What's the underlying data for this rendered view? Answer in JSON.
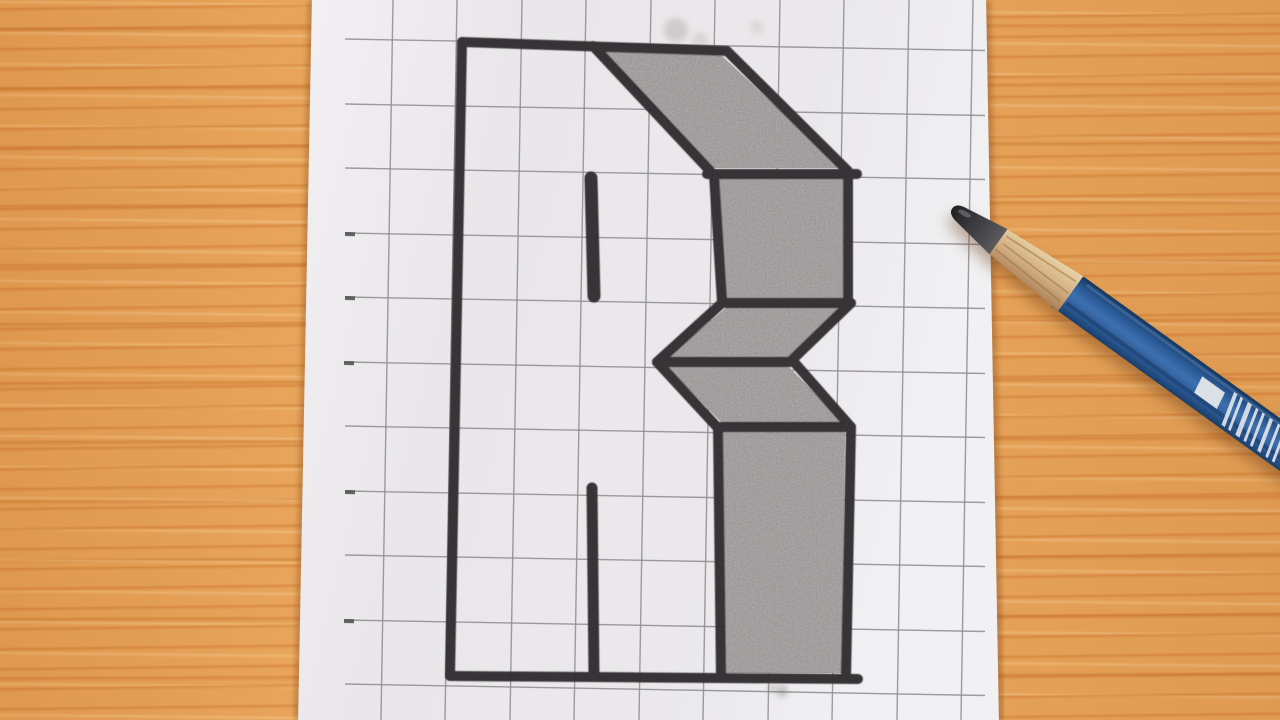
{
  "scene": {
    "type": "photograph",
    "subject": "hand-drawn 3D block letter B on graph paper, blue pencil resting on wooden desk",
    "desk": {
      "base_color": "#eaa85e",
      "streak_dark": "#cd7830",
      "streak_light": "#f8cb8c",
      "streak_deep": "#c16822"
    },
    "paper": {
      "polygon": [
        [
          312,
          -5
        ],
        [
          986,
          -5
        ],
        [
          999,
          725
        ],
        [
          298,
          725
        ]
      ],
      "gradient": [
        [
          0,
          "#f2f0f2"
        ],
        [
          0.3,
          "#e9e7e9"
        ],
        [
          0.72,
          "#eae8ea"
        ],
        [
          1,
          "#f1f0f2"
        ]
      ],
      "edge_shadow": "rgba(125,68,25,0.40)"
    },
    "grid": {
      "color": "#8d8b8e",
      "width": 1.4,
      "opacity": 0.85,
      "left_x": 345,
      "right_x": 985,
      "h_slope": 11.5,
      "v_slope": -12,
      "h_lines_y": [
        39,
        104,
        168,
        233,
        297,
        362,
        426,
        491,
        555,
        620,
        684
      ],
      "v_lines_x": [
        393,
        457,
        522,
        586,
        651,
        715,
        780,
        844,
        909,
        973
      ],
      "tick_color": "#4e4c4e",
      "ticks": [
        [
          345,
          234
        ],
        [
          345,
          298
        ],
        [
          344,
          363
        ],
        [
          345,
          492
        ],
        [
          344,
          621
        ]
      ]
    },
    "drawing": {
      "marker_color": "#312f31",
      "stroke_width": 10,
      "outline_segments": [
        [
          462,
          42,
          727,
          51
        ],
        [
          462,
          42,
          450,
          676
        ],
        [
          450,
          676,
          858,
          679
        ],
        [
          593,
          46,
          711,
          172
        ],
        [
          727,
          51,
          848,
          171
        ],
        [
          707,
          174,
          857,
          174
        ],
        [
          714,
          175,
          722,
          302
        ],
        [
          848,
          172,
          848,
          302
        ],
        [
          722,
          303,
          851,
          303
        ],
        [
          722,
          303,
          657,
          362
        ],
        [
          851,
          303,
          791,
          361
        ],
        [
          657,
          362,
          794,
          362
        ],
        [
          657,
          362,
          718,
          428
        ],
        [
          794,
          362,
          851,
          427
        ],
        [
          718,
          427,
          851,
          427
        ],
        [
          718,
          427,
          721,
          678
        ],
        [
          851,
          427,
          846,
          678
        ]
      ],
      "thick_dashes": [
        [
          591,
          178,
          594,
          296,
          13
        ],
        [
          592,
          488,
          594,
          676,
          11
        ]
      ],
      "shade_fill": "#adaaa9",
      "shaded_polygons": [
        [
          [
            597,
            51
          ],
          [
            722,
            56
          ],
          [
            842,
            168
          ],
          [
            713,
            168
          ]
        ],
        [
          [
            719,
            177
          ],
          [
            843,
            177
          ],
          [
            843,
            299
          ],
          [
            725,
            299
          ]
        ],
        [
          [
            727,
            307
          ],
          [
            845,
            307
          ],
          [
            787,
            358
          ],
          [
            666,
            358
          ]
        ],
        [
          [
            666,
            366
          ],
          [
            788,
            366
          ],
          [
            845,
            424
          ],
          [
            723,
            424
          ]
        ],
        [
          [
            723,
            431
          ],
          [
            845,
            431
          ],
          [
            842,
            673
          ],
          [
            725,
            673
          ]
        ]
      ],
      "smudge_color": "#6f6c6b",
      "smudges": [
        {
          "cx": 676,
          "cy": 30,
          "r": 12,
          "opacity": 0.22
        },
        {
          "cx": 700,
          "cy": 40,
          "r": 8,
          "opacity": 0.14
        },
        {
          "cx": 757,
          "cy": 27,
          "r": 7,
          "opacity": 0.12
        },
        {
          "cx": 782,
          "cy": 691,
          "r": 6,
          "opacity": 0.35
        },
        {
          "cx": 772,
          "cy": 688,
          "r": 4,
          "opacity": 0.3
        }
      ]
    },
    "pencil": {
      "tip": [
        949,
        206
      ],
      "angle_deg": 35.8,
      "graphite_path": "M4,0 Q4,-7 16,-8.5 L61,-15.5 L61,15.5 L16,8.5 Q4,7 4,0 Z",
      "graphite_stops": [
        [
          0,
          "#1e1e20"
        ],
        [
          0.45,
          "#3a393c"
        ],
        [
          1,
          "#5b5b60"
        ]
      ],
      "graphite_shine": {
        "cx": 17,
        "cy": -3,
        "rx": 7,
        "ry": 2.6,
        "fill": "#9a9aa0",
        "opacity": 0.45
      },
      "wood_path": "M58,-15 L150,-21.5 L150,21.5 L58,15 Z",
      "wood_stops": [
        [
          0,
          "#e9d2a8"
        ],
        [
          0.5,
          "#d4b284"
        ],
        [
          1,
          "#ab8258"
        ]
      ],
      "wood_streaks": [
        [
          64,
          -9,
          147,
          -13
        ],
        [
          66,
          -1,
          148,
          1
        ],
        [
          63,
          8,
          146,
          12
        ]
      ],
      "wood_streak_color": "rgba(150,110,65,0.5)",
      "body_path": "M152,-21.5 C137,-16 158,-11 146,-6 C134,-1 154,3 142,8 C132,12 151,16 141,21.5 L640,21.5 L640,-21.5 Z",
      "blue_stops": [
        [
          0,
          "#17375d"
        ],
        [
          0.25,
          "#2a5a96"
        ],
        [
          0.5,
          "#3e70b0"
        ],
        [
          0.75,
          "#2d5c99"
        ],
        [
          1,
          "#1a3e6b"
        ]
      ],
      "top_highlight": {
        "x1": 158,
        "y1": -16.5,
        "x2": 640,
        "y2": -16.5,
        "color": "rgba(130,175,225,0.28)",
        "w": 3
      },
      "facet_shadow": {
        "x1": 152,
        "y1": 10,
        "x2": 640,
        "y2": 10,
        "color": "rgba(8,22,45,0.28)",
        "w": 4
      },
      "white_block": "305,-10 333,-10 336,8 308,8",
      "mark_color": "#e9eaec",
      "stripes_along": [
        340,
        348,
        357,
        367,
        375,
        384,
        394,
        402,
        412,
        424,
        434,
        446,
        458,
        472,
        485,
        499
      ],
      "stripe_widths": [
        4,
        3,
        5,
        3,
        3,
        4,
        3,
        3,
        5,
        3,
        4,
        3,
        5,
        3,
        4,
        3
      ],
      "stripe_half": 16,
      "stripe_skew": 9,
      "shadow_css": "drop-shadow(-3px 9px 7px rgba(95,50,12,0.38))"
    }
  }
}
